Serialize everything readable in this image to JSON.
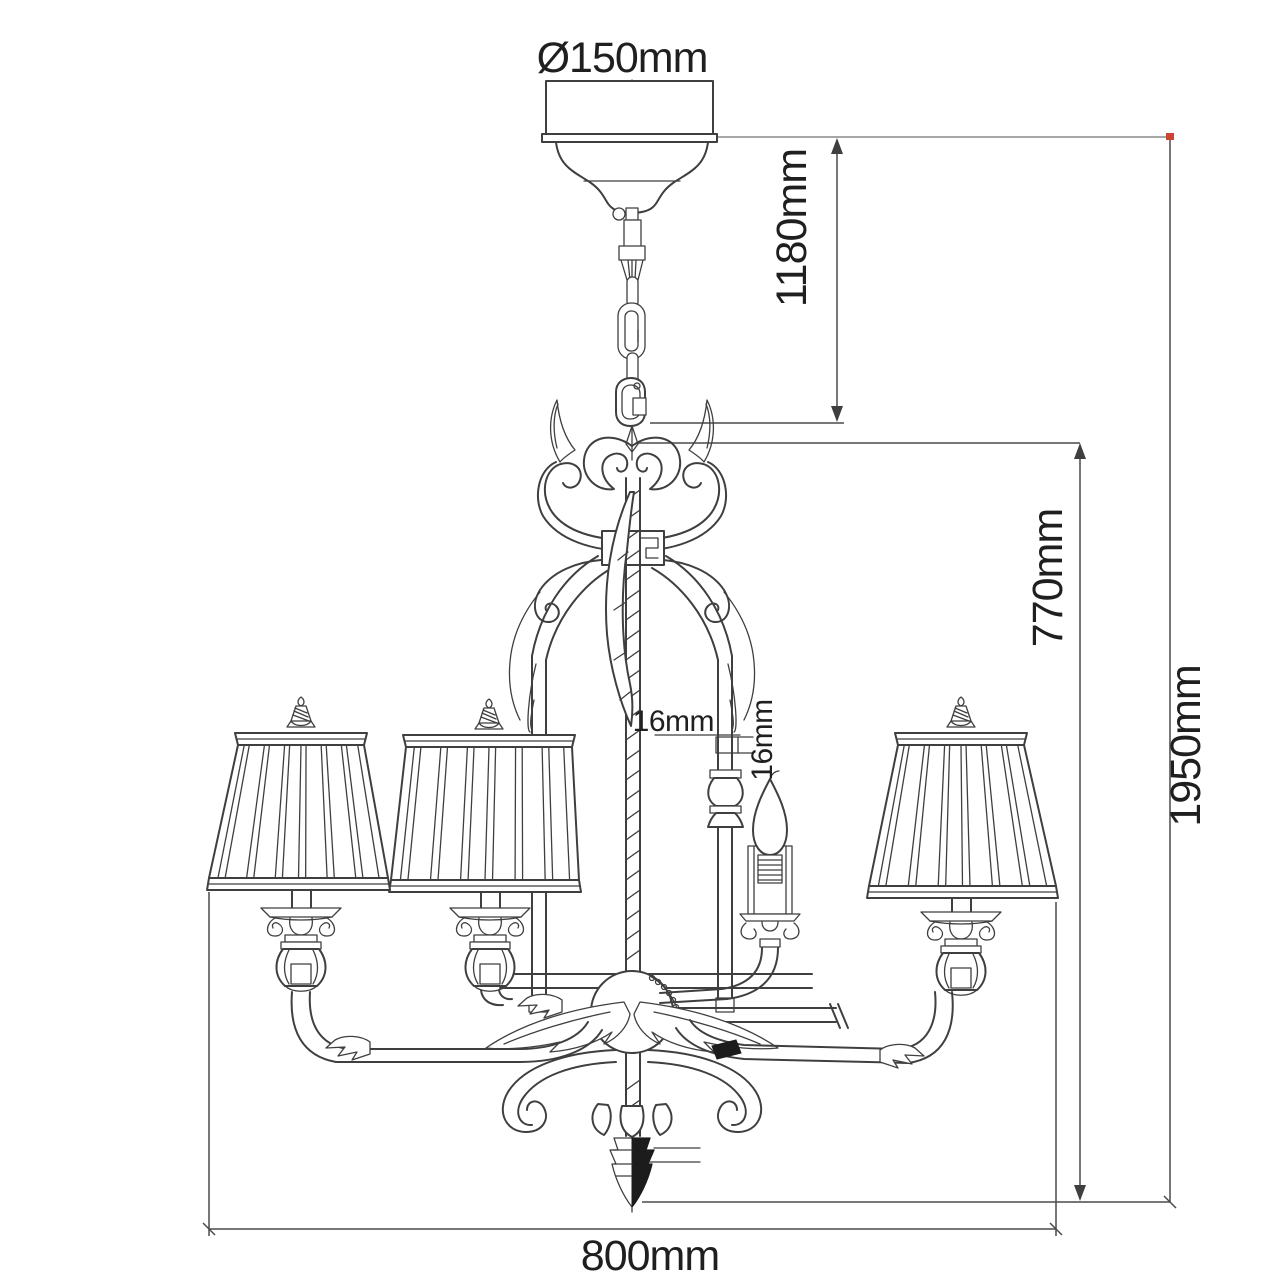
{
  "meta": {
    "type": "technical-dimension-diagram",
    "subject": "5-arm chandelier with pleated shades, ceiling canopy and chain suspension"
  },
  "labels": {
    "canopy_diameter": "Ø150mm",
    "suspension_length": "1180mm",
    "body_height": "770mm",
    "overall_height": "1950mm",
    "overall_width": "800mm",
    "stem_tube_diameter": "16mm",
    "candle_tube_diameter": "16mm"
  },
  "colors": {
    "drawing_line": "#3f3f3f",
    "extension_line": "#8a8a8a",
    "text": "#1f1f1f",
    "background": "#ffffff",
    "finial_fill": "#1c1c1c",
    "corner_marker": "#cc4433"
  }
}
